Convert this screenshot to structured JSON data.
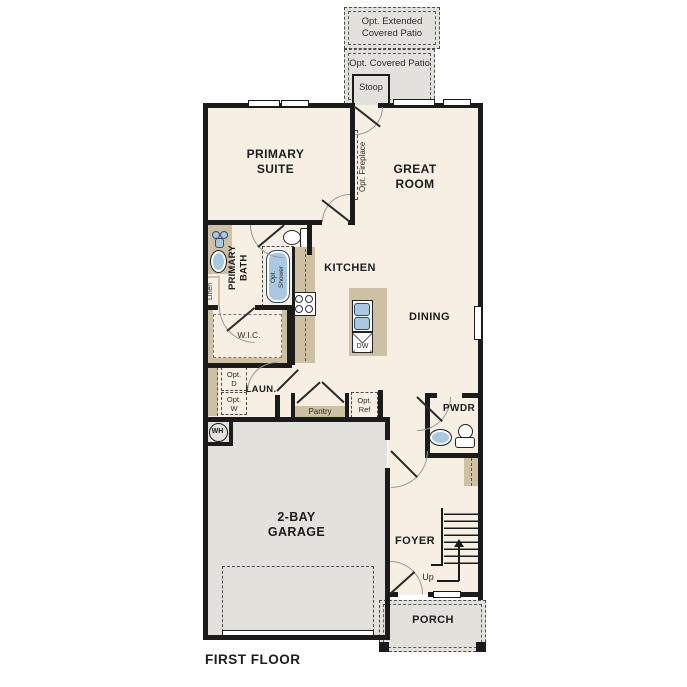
{
  "title": "FIRST FLOOR",
  "outdoor": {
    "extended_patio": "Opt. Extended\nCovered Patio",
    "covered_patio": "Opt. Covered Patio",
    "stoop": "Stoop",
    "porch": "PORCH"
  },
  "rooms": {
    "primary_suite": "PRIMARY\nSUITE",
    "great_room": "GREAT\nROOM",
    "kitchen": "KITCHEN",
    "dining": "DINING",
    "primary_bath": "PRIMARY\nBATH",
    "wic": "W.I.C.",
    "laundry": "LAUN.",
    "pantry": "Pantry",
    "powder": "PWDR",
    "foyer": "FOYER",
    "garage": "2-BAY\nGARAGE"
  },
  "options": {
    "fireplace": "Opt. Fireplace",
    "shower": "Opt.\nShower",
    "refrigerator": "Opt.\nRef",
    "dryer": "Opt.\nD",
    "washer": "Opt.\nW"
  },
  "fixtures": {
    "water_heater": "WH",
    "dishwasher": "DW",
    "linen": "Linen",
    "stairs_up": "Up"
  },
  "colors": {
    "floor": "#f7efe3",
    "outdoor": "#e3e1dc",
    "cabinet": "#cec0a3",
    "fixture_blue": "#a9c8e2",
    "wall": "#1b1b1b"
  }
}
